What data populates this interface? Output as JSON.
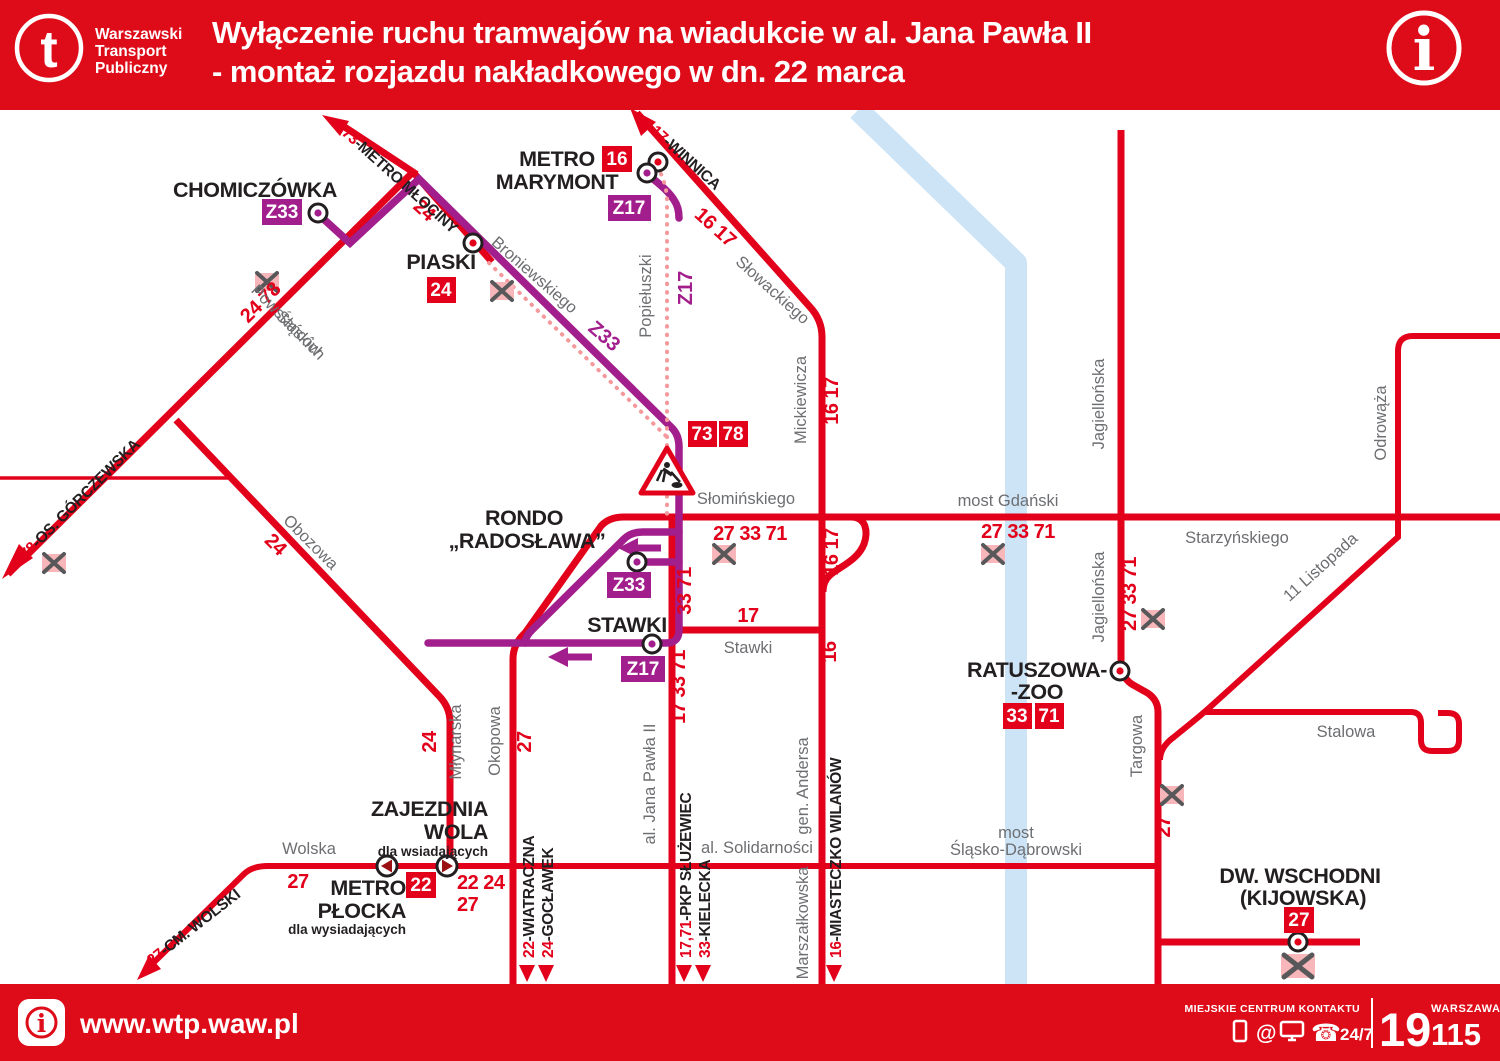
{
  "header": {
    "logo_glyph": "t",
    "brand": {
      "line1": "Warszawski",
      "line2": "Transport",
      "line3": "Publiczny"
    },
    "title_line1": "Wyłączenie ruchu tramwajów na wiadukcie w al. Jana Pawła II",
    "title_line2": "- montaż rozjazdu nakładkowego w dn. 22 marca",
    "info_icon": "i"
  },
  "colors": {
    "red": "#e2001a",
    "purple": "#a21e8c",
    "gray": "#6d6e71",
    "black": "#231f20",
    "river": "#cce4f6",
    "dotted": "#f5999d"
  },
  "stops": {
    "chomiczowka": "CHOMICZÓWKA",
    "metro_marymont_1": "METRO",
    "metro_marymont_2": "MARYMONT",
    "piaski": "PIASKI",
    "rondo_1": "RONDO",
    "rondo_2": "„RADOSŁAWA”",
    "stawki": "STAWKI",
    "zajezdnia_1": "ZAJEZDNIA",
    "zajezdnia_2": "WOLA",
    "zajezdnia_note": "dla wsiadających",
    "plocka_1": "METRO",
    "plocka_2": "PŁOCKA",
    "plocka_note": "dla wysiadających",
    "ratuszowa_1": "RATUSZOWA-",
    "ratuszowa_2": "-ZOO",
    "wschodni_1": "DW. WSCHODNI",
    "wschodni_2": "(KIJOWSKA)"
  },
  "badges": {
    "z33": "Z33",
    "z17": "Z17",
    "b16": "16",
    "b22": "22",
    "b24": "24",
    "b27": "27",
    "b33": "33",
    "b71": "71",
    "b73": "73",
    "b78": "78"
  },
  "route_labels": {
    "r24_78": "24 78",
    "r24": "24",
    "r16_17": "16 17",
    "r16": "16",
    "r17": "17",
    "r27": "27",
    "r27_33_71": "27 33 71",
    "r33_71": "33 71",
    "r17_33_71": "17 33 71",
    "r22_24": "22 24"
  },
  "destinations": {
    "d73": {
      "num": "73",
      "name": "-METRO MŁOCINY"
    },
    "d17": {
      "num": "17",
      "name": "-WINNICA"
    },
    "d78": {
      "num": "78",
      "name": "-OS. GÓRCZEWSKA"
    },
    "d27": {
      "num": "27",
      "name": "-CM. WOLSKI"
    },
    "d22": {
      "num": "22",
      "name": "-WIATRACZNA"
    },
    "d24": {
      "num": "24",
      "name": "-GOCŁAWEK"
    },
    "d17_71": {
      "num": "17,71",
      "name": "-PKP SŁUŻEWIEC"
    },
    "d33": {
      "num": "33",
      "name": "-KIELECKA"
    },
    "d16": {
      "num": "16",
      "name": "-MIASTECZKO WILANÓW"
    }
  },
  "streets": {
    "powstancow_1": "Powstańców",
    "powstancow_2": "Śląskich",
    "broniewskiego": "Broniewskiego",
    "popieluszki": "Popiełuszki",
    "slowackiego": "Słowackiego",
    "mickiewicza": "Mickiewicza",
    "gen_andersa": "gen. Andersa",
    "marszalkowska": "Marszałkowska",
    "obozowa": "Obozowa",
    "mlynarska": "Młynarska",
    "okopowa": "Okopowa",
    "jana_pawla": "al. Jana Pawła II",
    "slominskiego": "Słomińskiego",
    "stawki": "Stawki",
    "most_gdanski": "most Gdański",
    "starzynskiego": "Starzyńskiego",
    "jagiellonska": "Jagiellońska",
    "listopada": "11 Listopada",
    "odrowaza": "Odrowąża",
    "stalowa": "Stalowa",
    "most_slasko_1": "most",
    "most_slasko_2": "Śląsko-Dąbrowski",
    "solidarnosci": "al. Solidarności",
    "wolska": "Wolska",
    "targowa": "Targowa"
  },
  "footer": {
    "url": "www.wtp.waw.pl",
    "info_icon": "i",
    "contact": "MIEJSKIE CENTRUM KONTAKTU",
    "at_icon": "@",
    "phone_icon": "☎",
    "avail": "24/7",
    "num_19": "19",
    "city": "WARSZAWA",
    "num_115": "115"
  }
}
